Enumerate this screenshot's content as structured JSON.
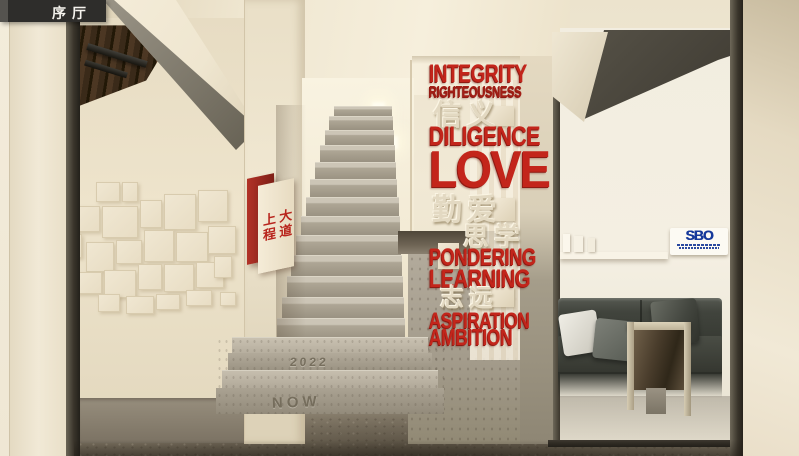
{
  "window": {
    "label_bar": "序厅"
  },
  "culture_wall": {
    "rows": [
      {
        "text": "INTEGRITY",
        "lang": "en"
      },
      {
        "text": "RIGHTEOUSNESS",
        "lang": "en"
      },
      {
        "text": "信义",
        "lang": "cn"
      },
      {
        "text": "DILIGENCE",
        "lang": "en"
      },
      {
        "text": "LOVE",
        "lang": "en"
      },
      {
        "text": "勤爱",
        "lang": "cn"
      },
      {
        "text": "思学",
        "lang": "cn"
      },
      {
        "text": "PONDERING",
        "lang": "en"
      },
      {
        "text": "LEARNING",
        "lang": "en"
      },
      {
        "text": "志远",
        "lang": "cn"
      },
      {
        "text": "ASPIRATION",
        "lang": "en"
      },
      {
        "text": "AMBITION",
        "lang": "en"
      }
    ]
  },
  "wayfinding_sign": {
    "column_right": "大道",
    "column_left": "上程"
  },
  "staircase": {
    "riser_year": "2022",
    "riser_now": "NOW"
  },
  "sbo_plaque": {
    "logo_text": "SBO"
  },
  "palette": {
    "accent_red": "#c3251b",
    "cream": "#efe6d1",
    "concrete": "#a9a192",
    "sbo_blue": "#16399b"
  }
}
